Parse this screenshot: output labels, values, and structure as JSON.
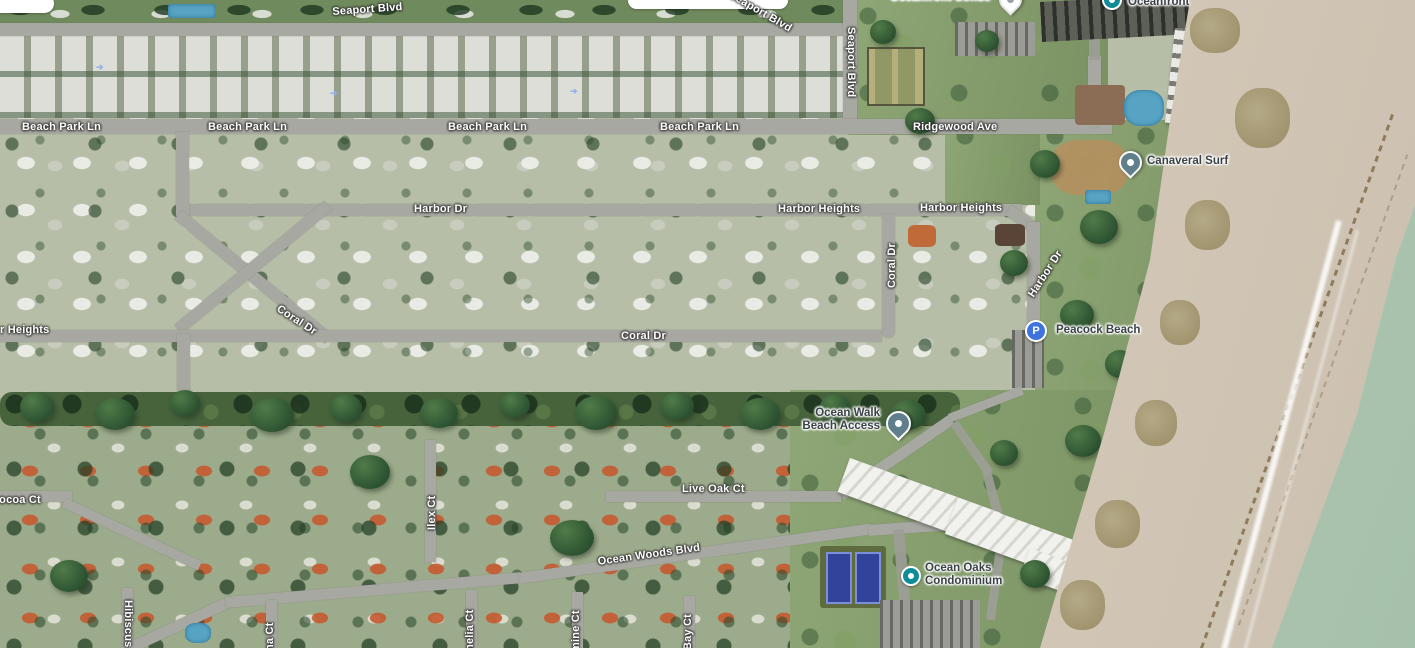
{
  "roads": {
    "seaport_blvd": "Seaport Blvd",
    "beach_park_ln": "Beach Park Ln",
    "ridgewood_ave": "Ridgewood Ave",
    "harbor_dr": "Harbor Dr",
    "harbor_heights": "Harbor Heights",
    "harbor_heights_cut": "r Heights",
    "coral_dr": "Coral Dr",
    "cocoa_ct": "Cocoa Ct",
    "ilex_ct": "Ilex Ct",
    "live_oak_ct": "Live Oak Ct",
    "ocean_woods_blvd": "Ocean Woods Blvd",
    "hibiscus": "Hibiscus",
    "na_ct": "na Ct",
    "melia_ct": "melia Ct",
    "mine_ct": "mine Ct",
    "bay_ct": "Bay Ct"
  },
  "places": {
    "oceanfront_condo": "Oceanfront Condo",
    "oceanfront": "Oceanfront",
    "canaveral_surf": "Canaveral Surf",
    "peacock_beach": "Peacock Beach",
    "ocean_walk_line1": "Ocean Walk",
    "ocean_walk_line2": "Beach Access",
    "ocean_oaks_line1": "Ocean Oaks",
    "ocean_oaks_line2": "Condominium",
    "parking_glyph": "P"
  },
  "colors": {
    "road_label": "#ffffff",
    "poi_label": "#3a4247",
    "poi_teal": "#0e8d96",
    "parking_blue": "#3e73dd",
    "pin_slate": "#5f7f8d",
    "water": "#a9c4b2",
    "sand": "#d8cfc1"
  }
}
